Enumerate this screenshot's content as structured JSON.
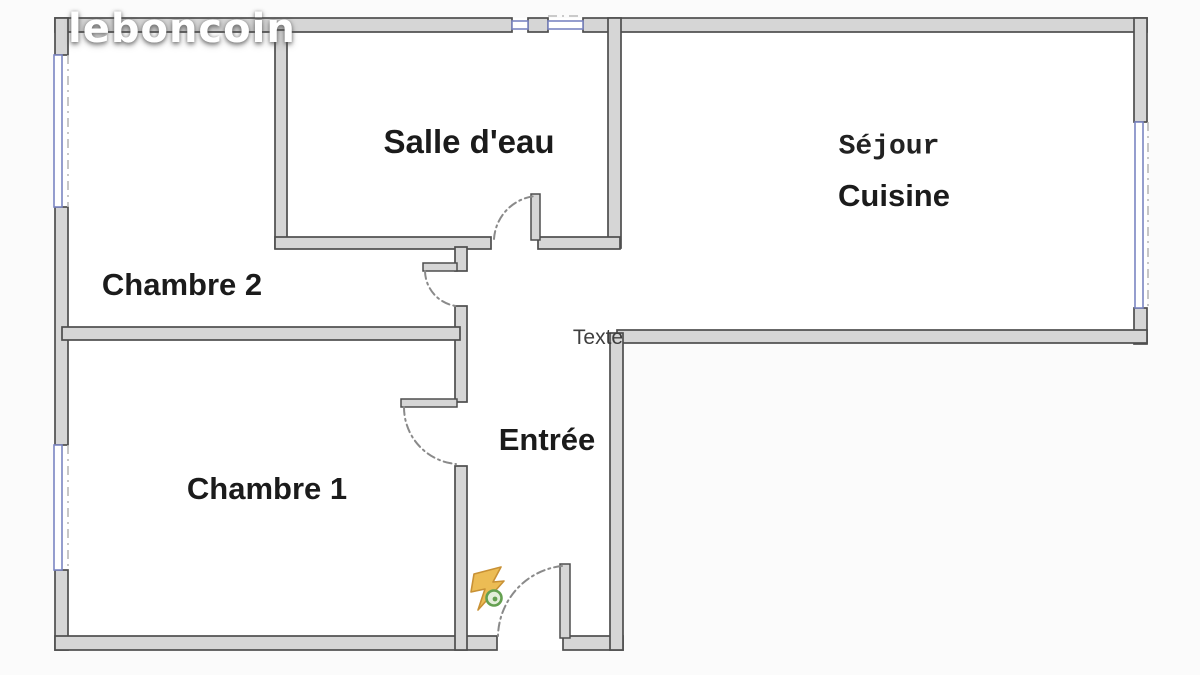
{
  "watermark": {
    "logo_text": "leboncoin"
  },
  "floor_plan": {
    "rooms": {
      "salle_deau": {
        "label": "Salle d'eau"
      },
      "sejour_cuisine": {
        "label_line1": "Séjour",
        "label_line2": "Cuisine"
      },
      "chambre_2": {
        "label": "Chambre 2"
      },
      "chambre_1": {
        "label": "Chambre 1"
      },
      "entree": {
        "label": "Entrée"
      }
    },
    "annotations": {
      "texte": "Texte"
    },
    "features": {
      "door_count": 4,
      "window_count": 4,
      "power_icon": "electrical-flash-icon"
    },
    "colors": {
      "wall_fill": "#d6d6d6",
      "wall_edge": "#4e4e4e",
      "window_frame": "#7b85c2",
      "door_arc": "#8a8a8a",
      "room_label": "#1b1b1b",
      "annotation_gray": "#3f3f3f",
      "logo_white": "#ffffff",
      "icon_yellow": "#ecbc54",
      "icon_outline": "#c89135",
      "icon_green": "#64a050"
    }
  }
}
